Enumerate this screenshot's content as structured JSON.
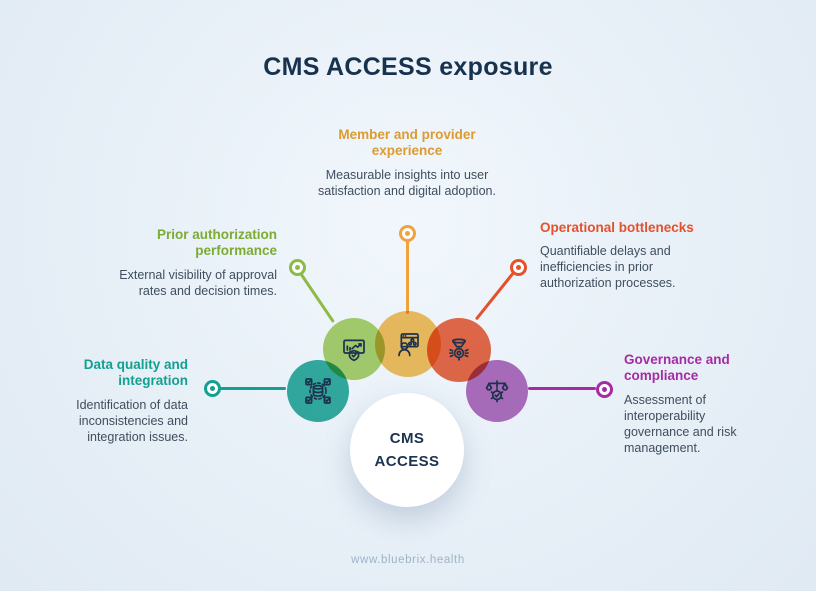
{
  "title": "CMS ACCESS exposure",
  "center": {
    "line1": "CMS",
    "line2": "ACCESS"
  },
  "footer": "www.bluebrix.health",
  "colors": {
    "background": "#e7eff7",
    "title_text": "#17324e",
    "body_text": "#3f4e5e",
    "footer_text": "#a0b4c6",
    "hub_background": "#ffffff"
  },
  "nodes": [
    {
      "id": "data-quality",
      "title": "Data quality and integration",
      "description": "Identification of data inconsistencies and integration issues.",
      "accent_color": "#12a091",
      "circle_color": "#35afa1",
      "icon": "database-check-icon"
    },
    {
      "id": "prior-authorization",
      "title": "Prior authorization performance",
      "description": "External visibility of approval rates and decision times.",
      "accent_color": "#7cab33",
      "circle_color": "#abd26d",
      "icon": "chart-shield-icon"
    },
    {
      "id": "member-provider",
      "title": "Member and provider experience",
      "description": "Measurable insights into user satisfaction and digital adoption.",
      "accent_color": "#dd9a2f",
      "circle_color": "#f6c05f",
      "icon": "user-window-icon"
    },
    {
      "id": "operational-bottlenecks",
      "title": "Operational bottlenecks",
      "description": "Quantifiable delays and inefficiencies in prior authorization processes.",
      "accent_color": "#e4512b",
      "circle_color": "#ed6b48",
      "icon": "funnel-gear-icon"
    },
    {
      "id": "governance-compliance",
      "title": "Governance and compliance",
      "description": "Assessment of interoperability governance and risk management.",
      "accent_color": "#a62ba2",
      "circle_color": "#b470bd",
      "icon": "scale-gear-icon"
    }
  ]
}
